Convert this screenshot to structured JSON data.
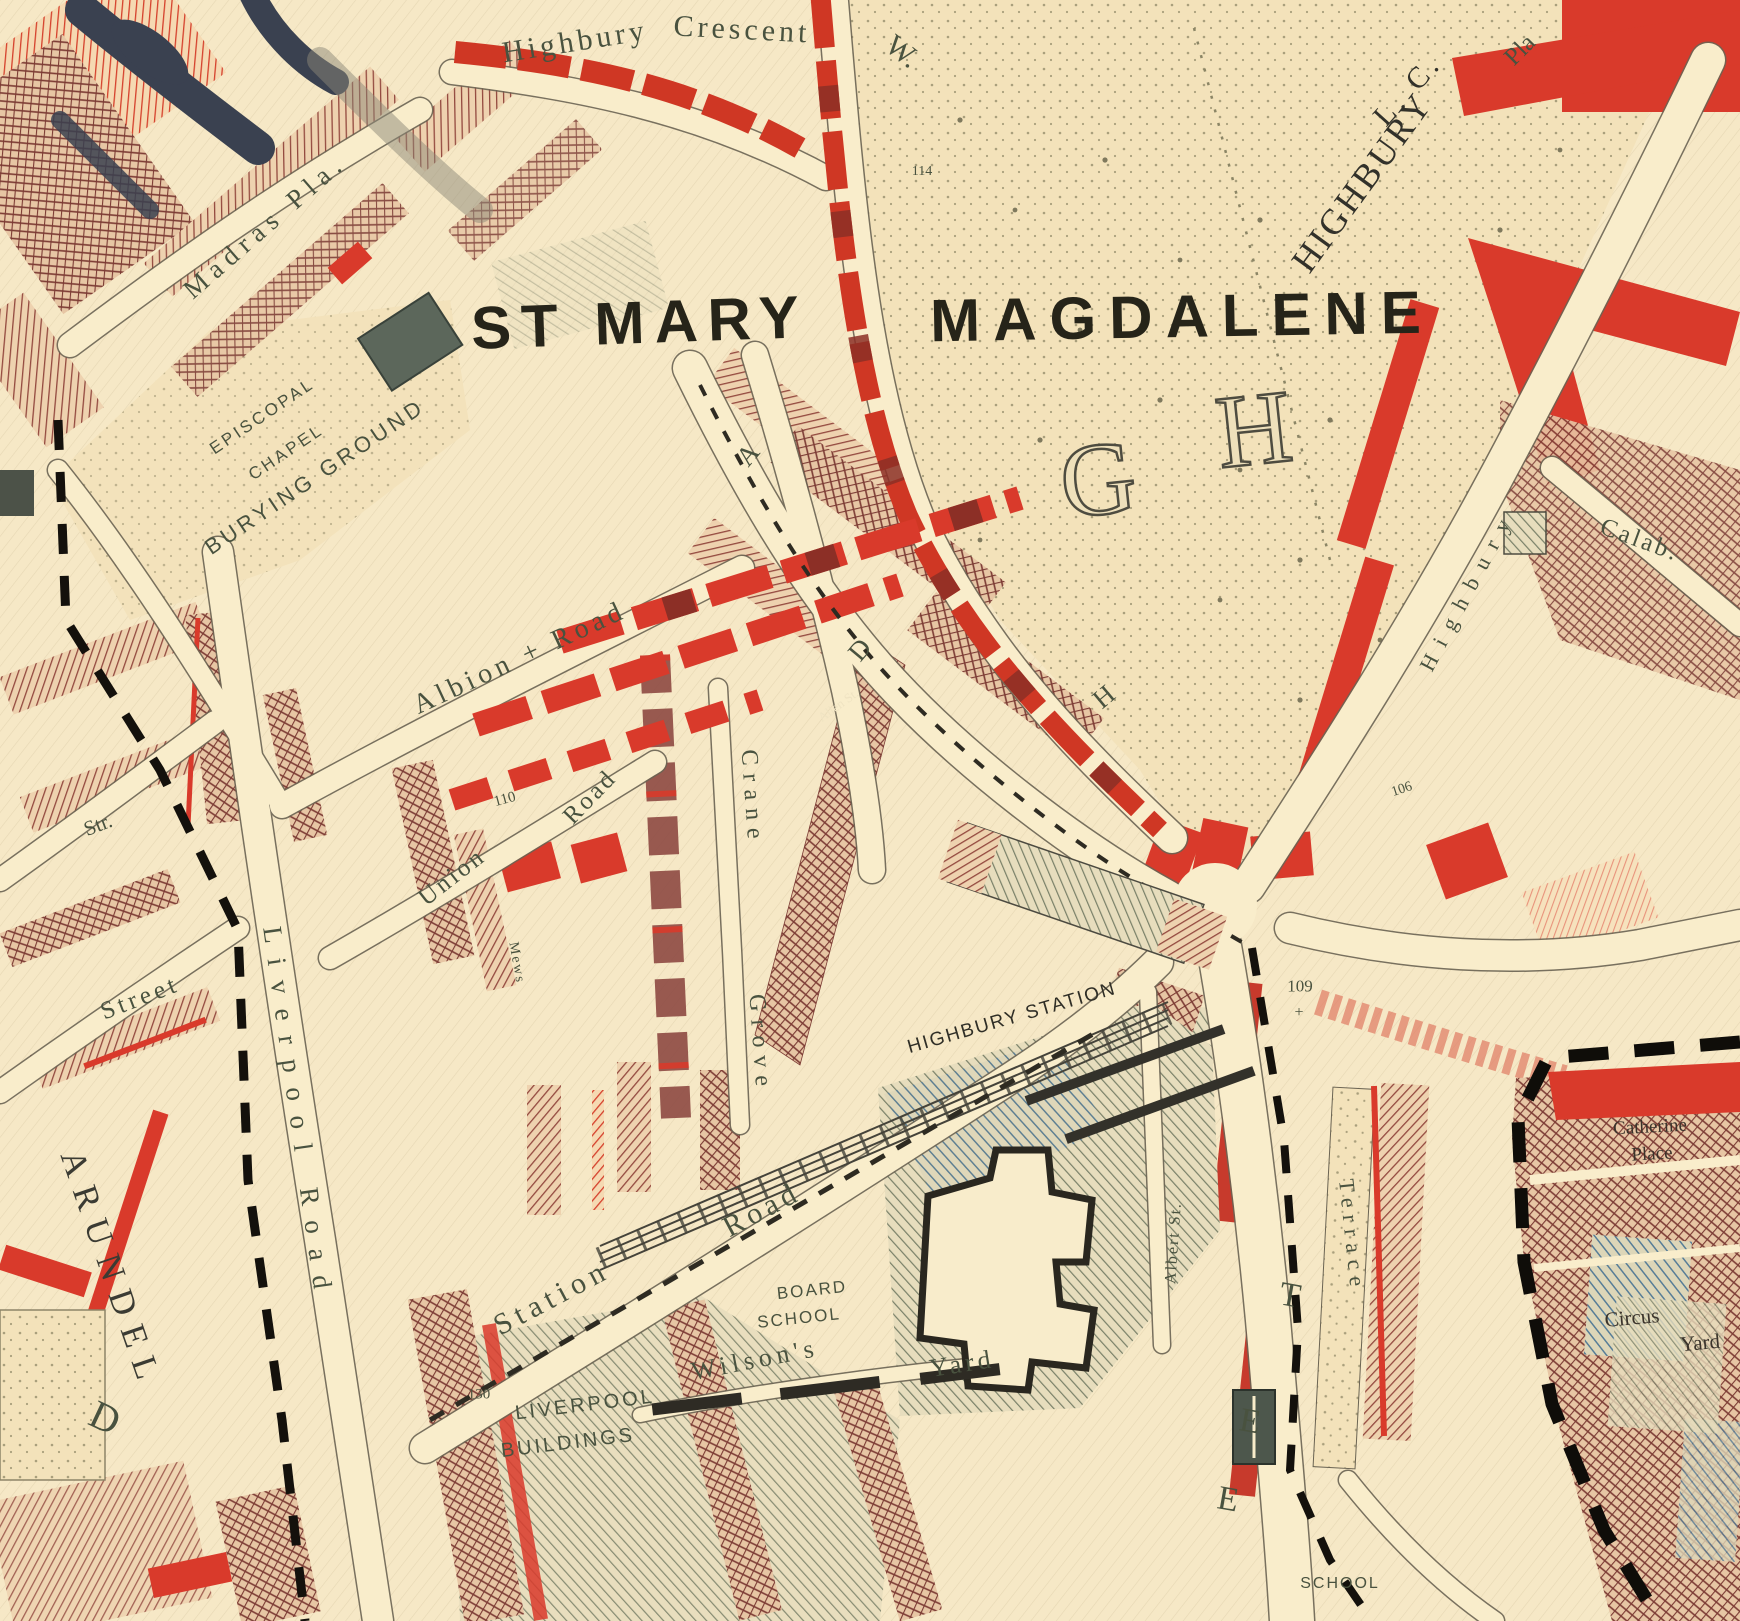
{
  "map": {
    "region_name": "ST MARY MAGDALENE",
    "palette": {
      "background_cream": "#f6e8c6",
      "road_cream": "#f9edcb",
      "well_to_do_red": "#d93a2b",
      "dark_red_mixed": "#8e4a43",
      "pink_hatch": "#e8937b",
      "poor_blue": "#577d97",
      "building_grey_green": "#5c675b",
      "park_stipple": "#a99f7c",
      "boundary_black": "#14110c",
      "label_black": "#262419",
      "label_grey_green": "#49523f",
      "manuscript_ink": "#3a4150"
    },
    "labels": [
      {
        "t": "Highbury",
        "x": 575,
        "y": 42,
        "r": -9,
        "s": 30,
        "ls": 4,
        "f": "serif",
        "n": "street-label-highbury-crescent-w-1"
      },
      {
        "t": "Crescent",
        "x": 742,
        "y": 30,
        "r": 3,
        "s": 30,
        "ls": 4,
        "f": "serif",
        "n": "street-label-highbury-crescent-w-2"
      },
      {
        "t": "W.",
        "x": 902,
        "y": 52,
        "r": 38,
        "s": 30,
        "f": "serif",
        "n": "street-label-highbury-crescent-w-3"
      },
      {
        "t": "ST MARY",
        "x": 640,
        "y": 323,
        "r": -2,
        "s": 60,
        "ls": 10,
        "f": "sans",
        "w": 700,
        "c": "#262419",
        "n": "parish-label-st-mary"
      },
      {
        "t": "MAGDALENE",
        "x": 1182,
        "y": 317,
        "r": -1,
        "s": 60,
        "ls": 13,
        "f": "sans",
        "w": 700,
        "c": "#262419",
        "n": "parish-label-magdalene"
      },
      {
        "t": "HIGHBURY",
        "x": 1362,
        "y": 182,
        "r": -54,
        "s": 36,
        "ls": 3,
        "f": "serif",
        "c": "#32312a",
        "n": "district-label-highbury"
      },
      {
        "t": "L. C.",
        "x": 1408,
        "y": 90,
        "r": -48,
        "s": 30,
        "ls": 5,
        "f": "serif",
        "c": "#32312a",
        "n": "label-lc"
      },
      {
        "t": "Pla",
        "x": 1520,
        "y": 50,
        "r": -45,
        "s": 25,
        "f": "serif",
        "n": "street-label-pla"
      },
      {
        "t": "Madras Pla.",
        "x": 265,
        "y": 226,
        "r": -41,
        "s": 27,
        "ls": 7,
        "f": "serif",
        "n": "street-label-madras-place"
      },
      {
        "t": "EPISCOPAL",
        "x": 262,
        "y": 416,
        "r": -34,
        "s": 17,
        "ls": 3,
        "f": "sans",
        "n": "label-episcopal"
      },
      {
        "t": "CHAPEL",
        "x": 286,
        "y": 452,
        "r": -34,
        "s": 17,
        "ls": 3,
        "f": "sans",
        "n": "label-chapel"
      },
      {
        "t": "BURYING GROUND",
        "x": 315,
        "y": 477,
        "r": -34,
        "s": 22,
        "ls": 4,
        "f": "sans",
        "n": "label-burying-ground"
      },
      {
        "t": "Albion + Road",
        "x": 520,
        "y": 658,
        "r": -25,
        "s": 28,
        "ls": 5,
        "f": "serif",
        "n": "street-label-albion-road"
      },
      {
        "t": "110",
        "x": 505,
        "y": 800,
        "r": -15,
        "s": 15,
        "f": "serif",
        "n": "number-110"
      },
      {
        "t": "Union",
        "x": 452,
        "y": 877,
        "r": -38,
        "s": 25,
        "ls": 3,
        "f": "serif",
        "n": "street-label-union-road-1"
      },
      {
        "t": "Road",
        "x": 590,
        "y": 797,
        "r": -46,
        "s": 25,
        "ls": 3,
        "f": "serif",
        "n": "street-label-union-road-2"
      },
      {
        "t": "Mews",
        "x": 516,
        "y": 963,
        "r": 80,
        "s": 14,
        "ls": 2,
        "f": "serif",
        "n": "street-label-mews"
      },
      {
        "t": "Crane",
        "x": 752,
        "y": 798,
        "r": 86,
        "s": 24,
        "ls": 8,
        "f": "serif",
        "n": "street-label-crane-grove-1"
      },
      {
        "t": "Grove",
        "x": 760,
        "y": 1044,
        "r": 86,
        "s": 24,
        "ls": 8,
        "f": "serif",
        "n": "street-label-crane-grove-2"
      },
      {
        "t": "Allen St.",
        "x": 838,
        "y": 705,
        "r": -36,
        "s": 13,
        "c": "#efe3c2",
        "f": "serif",
        "n": "street-label-allen-st"
      },
      {
        "t": "A",
        "x": 748,
        "y": 455,
        "r": -50,
        "s": 27,
        "f": "serif",
        "n": "road-letter-a"
      },
      {
        "t": "D",
        "x": 860,
        "y": 650,
        "r": -50,
        "s": 27,
        "f": "serif",
        "n": "road-letter-d"
      },
      {
        "t": "H",
        "x": 1104,
        "y": 697,
        "r": -40,
        "s": 27,
        "f": "serif",
        "n": "road-letter-h"
      },
      {
        "t": "G",
        "x": 1098,
        "y": 480,
        "r": -6,
        "s": 104,
        "f": "serif",
        "o": true,
        "n": "outline-letter-g"
      },
      {
        "t": "H",
        "x": 1254,
        "y": 430,
        "r": -6,
        "s": 104,
        "f": "serif",
        "o": true,
        "n": "outline-letter-h"
      },
      {
        "t": "114",
        "x": 922,
        "y": 172,
        "s": 14,
        "f": "serif",
        "n": "number-114"
      },
      {
        "t": "HIGHBURY STATION",
        "x": 1012,
        "y": 1018,
        "r": -16,
        "s": 19,
        "ls": 2,
        "f": "sans",
        "c": "#2f2e26",
        "n": "label-highbury-station"
      },
      {
        "t": "109",
        "x": 1300,
        "y": 986,
        "s": 17,
        "f": "serif",
        "n": "number-109"
      },
      {
        "t": "+",
        "x": 1299,
        "y": 1013,
        "s": 16,
        "f": "serif",
        "n": "benchmark-cross"
      },
      {
        "t": "106",
        "x": 1402,
        "y": 790,
        "r": -18,
        "s": 14,
        "f": "serif",
        "n": "number-106"
      },
      {
        "t": "Calab.",
        "x": 1640,
        "y": 540,
        "r": 20,
        "s": 25,
        "ls": 3,
        "f": "serif",
        "n": "street-label-calabria"
      },
      {
        "t": "Highbury",
        "x": 1468,
        "y": 590,
        "r": -62,
        "s": 22,
        "ls": 12,
        "f": "serif",
        "n": "street-label-highbury-place"
      },
      {
        "t": "Station",
        "x": 552,
        "y": 1298,
        "r": -28,
        "s": 30,
        "ls": 6,
        "f": "serif",
        "n": "street-label-station-road-1"
      },
      {
        "t": "Road",
        "x": 762,
        "y": 1210,
        "r": -28,
        "s": 30,
        "ls": 5,
        "f": "serif",
        "n": "street-label-station-road-2"
      },
      {
        "t": "BOARD",
        "x": 812,
        "y": 1290,
        "r": -6,
        "s": 17,
        "ls": 2,
        "f": "sans",
        "n": "label-board-school-1"
      },
      {
        "t": "SCHOOL",
        "x": 799,
        "y": 1318,
        "r": -6,
        "s": 17,
        "ls": 2,
        "f": "sans",
        "n": "label-board-school-2"
      },
      {
        "t": "LIVERPOOL",
        "x": 585,
        "y": 1405,
        "r": -7,
        "s": 20,
        "ls": 3,
        "f": "sans",
        "n": "label-liverpool-buildings-1"
      },
      {
        "t": "BUILDINGS",
        "x": 568,
        "y": 1443,
        "r": -7,
        "s": 20,
        "ls": 3,
        "f": "sans",
        "n": "label-liverpool-buildings-2"
      },
      {
        "t": "Wilson's",
        "x": 755,
        "y": 1360,
        "r": -11,
        "s": 26,
        "ls": 5,
        "f": "serif",
        "n": "label-wilsons-yard-1"
      },
      {
        "t": "Yard",
        "x": 962,
        "y": 1364,
        "r": -9,
        "s": 26,
        "ls": 4,
        "f": "serif",
        "n": "label-wilsons-yard-2"
      },
      {
        "t": "130",
        "x": 479,
        "y": 1395,
        "s": 15,
        "f": "serif",
        "n": "number-130"
      },
      {
        "t": "Albert St.",
        "x": 1174,
        "y": 1243,
        "r": -86,
        "s": 16,
        "ls": 2,
        "f": "serif",
        "n": "street-label-albert-st"
      },
      {
        "t": "Terrace",
        "x": 1352,
        "y": 1236,
        "r": 84,
        "s": 22,
        "ls": 7,
        "f": "serif",
        "n": "street-label-terrace"
      },
      {
        "t": "T",
        "x": 1290,
        "y": 1296,
        "r": 10,
        "s": 34,
        "f": "serif",
        "n": "street-letter-t"
      },
      {
        "t": "E",
        "x": 1250,
        "y": 1422,
        "r": 10,
        "s": 34,
        "f": "serif",
        "n": "street-letter-e1"
      },
      {
        "t": "E",
        "x": 1228,
        "y": 1500,
        "r": 10,
        "s": 34,
        "f": "serif",
        "n": "street-letter-e2"
      },
      {
        "t": "ARUNDEL",
        "x": 112,
        "y": 1270,
        "r": 71,
        "s": 35,
        "ls": 12,
        "f": "serif",
        "c": "#3b3b33",
        "n": "street-label-arundel"
      },
      {
        "t": "Str.",
        "x": 98,
        "y": 825,
        "r": -21,
        "s": 21,
        "f": "serif",
        "n": "street-label-str"
      },
      {
        "t": "Street",
        "x": 140,
        "y": 998,
        "r": -21,
        "s": 25,
        "ls": 4,
        "f": "serif",
        "n": "street-label-street"
      },
      {
        "t": "Liverpool Road",
        "x": 298,
        "y": 1115,
        "r": 82,
        "s": 27,
        "ls": 15,
        "f": "serif",
        "n": "street-label-liverpool-road"
      },
      {
        "t": "Catherine",
        "x": 1650,
        "y": 1127,
        "r": -3,
        "s": 19,
        "f": "serif",
        "c": "#3a332b",
        "n": "label-catherine-place-1"
      },
      {
        "t": "Place",
        "x": 1652,
        "y": 1154,
        "r": -3,
        "s": 19,
        "f": "serif",
        "c": "#3a332b",
        "n": "label-catherine-place-2"
      },
      {
        "t": "Circus",
        "x": 1632,
        "y": 1318,
        "r": -5,
        "s": 21,
        "f": "serif",
        "c": "#3a332b",
        "n": "label-circus-yard-1"
      },
      {
        "t": "Yard",
        "x": 1700,
        "y": 1343,
        "r": -5,
        "s": 21,
        "f": "serif",
        "c": "#3a332b",
        "n": "label-circus-yard-2"
      },
      {
        "t": "SCHOOL",
        "x": 1340,
        "y": 1584,
        "s": 16,
        "ls": 2,
        "f": "sans",
        "n": "label-school"
      },
      {
        "t": "D",
        "x": 105,
        "y": 1418,
        "r": 25,
        "s": 40,
        "f": "serif",
        "n": "street-letter-d"
      }
    ]
  }
}
